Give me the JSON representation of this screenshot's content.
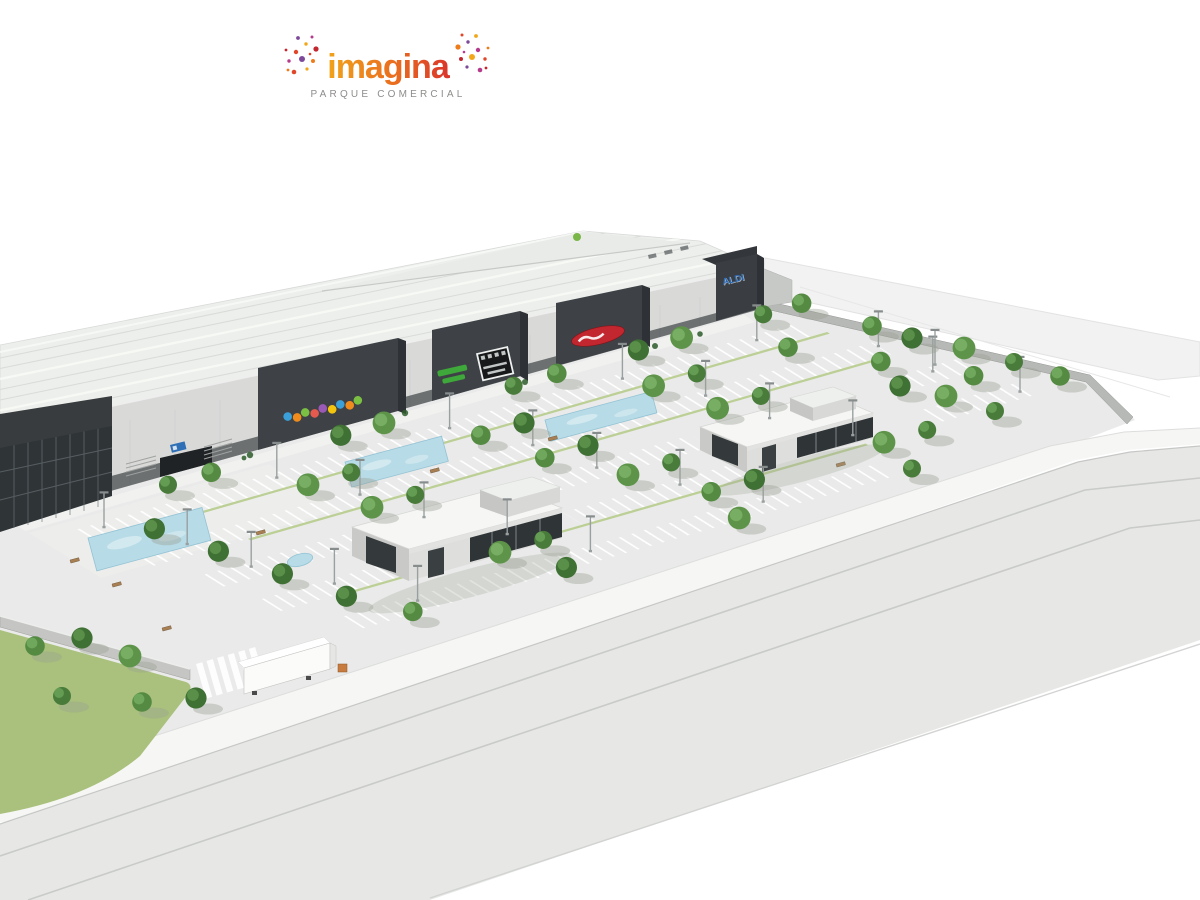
{
  "logo": {
    "brand": "imagina",
    "subtitle": "PARQUE  COMERCIAL",
    "brand_gradient": [
      "#f0a31a",
      "#ea6d1f",
      "#d9342b"
    ],
    "confetti_colors": [
      "#e0472a",
      "#f2a71b",
      "#c2272f",
      "#b63a8c",
      "#7d4a9a",
      "#ef7c1a"
    ],
    "subtitle_color": "#8e8d8b"
  },
  "signs": {
    "aldi": "ALDI",
    "aldi_color": "#2d6db8",
    "toy_store_colors": [
      "#3b9fd8",
      "#f08c1e",
      "#7bc043",
      "#e45a4f",
      "#9b59b6",
      "#f2c40e"
    ],
    "sports_sign_color": "#3fae3a",
    "supermarket_sign_color": "#c2262e"
  },
  "palette": {
    "background": "#ffffff",
    "roof": "#edefec",
    "facade_light": "#d9dad8",
    "facade_dark": "#3e4246",
    "glass": "#2f3437",
    "parking": "#e9eae9",
    "road": "#e7e8e6",
    "sidewalk": "#f6f6f5",
    "grass": "#a9c17c",
    "tree": "#497c3b",
    "water_feature": "#b7dbe7",
    "median_green": "#bccf95"
  }
}
